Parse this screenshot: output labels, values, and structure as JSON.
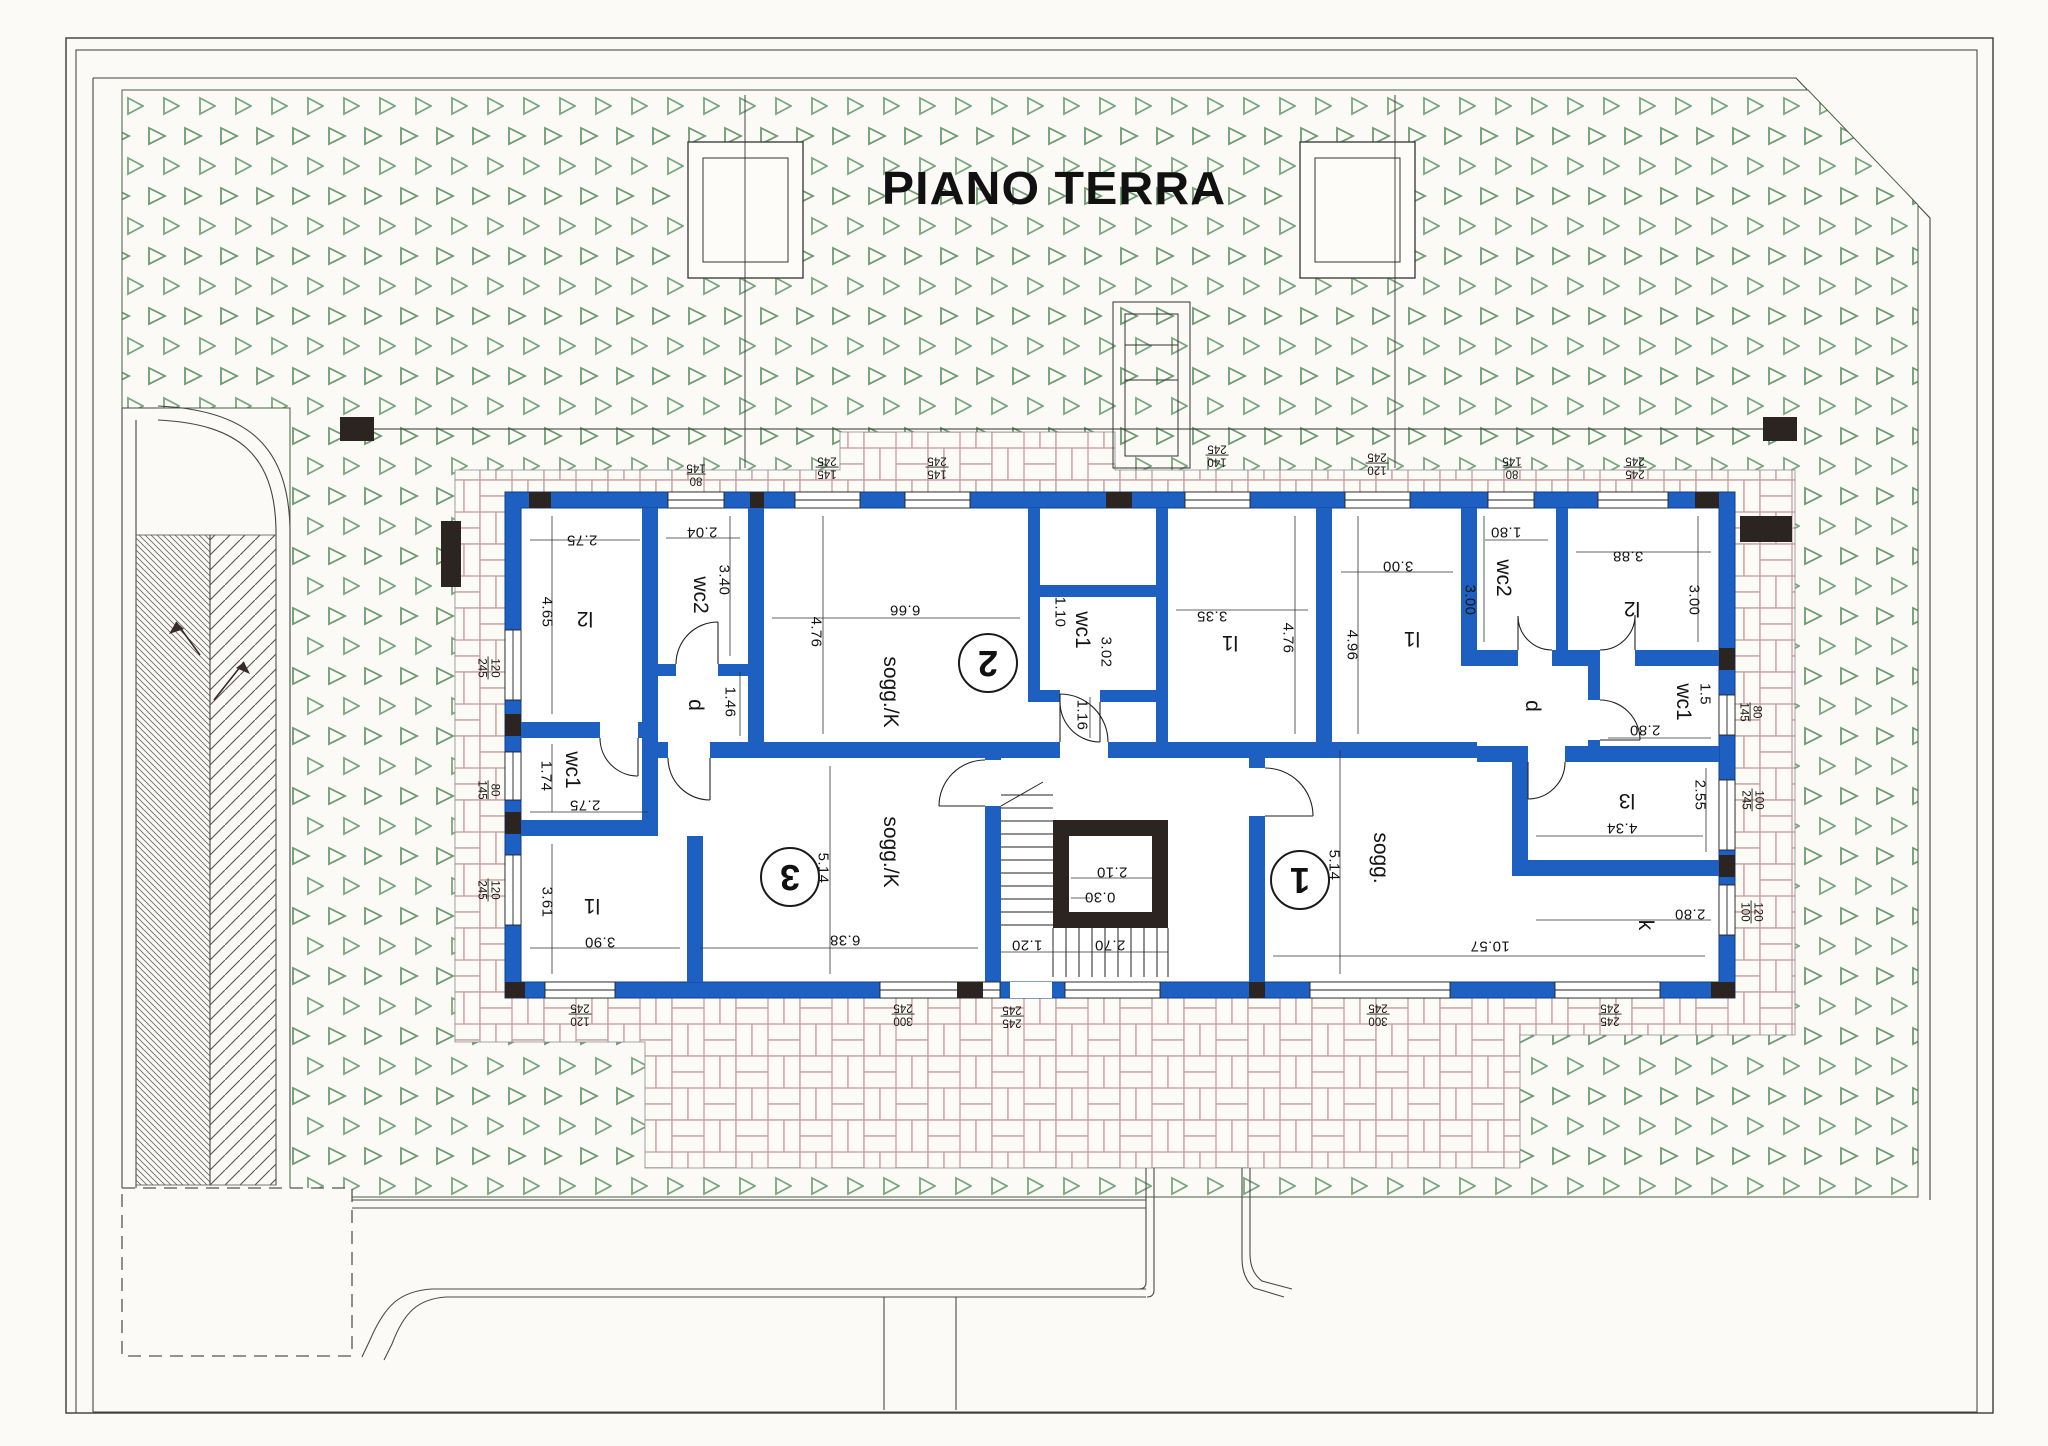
{
  "title": "PIANO TERRA",
  "apartments": {
    "apt1": {
      "number": "1"
    },
    "apt2": {
      "number": "2"
    },
    "apt3": {
      "number": "3"
    }
  },
  "rooms": {
    "a3_l2": {
      "label": "l2",
      "w": "2.75",
      "h": "4.65"
    },
    "a3_wc2": {
      "label": "wc2",
      "w": "2.04",
      "h": "3.40"
    },
    "a3_wc1": {
      "label": "wc1",
      "w": "2.75",
      "h": "1.74"
    },
    "a3_l1": {
      "label": "l1",
      "w": "3.90",
      "h": "3.61"
    },
    "a3_d": {
      "label": "d",
      "h": "1.46"
    },
    "a3_sogg": {
      "label": "sogg./K",
      "w": "6.38",
      "h": "5.14"
    },
    "a2_sogg": {
      "label": "sogg./K",
      "w": "6.66",
      "h": "4.76"
    },
    "a2_wc1": {
      "label": "wc1",
      "w": "3.02",
      "h": "1.10"
    },
    "a2_l1": {
      "label": "l1",
      "w": "3.35",
      "h": "4.76"
    },
    "a2_door": {
      "dim": "1.16"
    },
    "a1_l1": {
      "label": "l1",
      "w": "3.00",
      "h": "4.96"
    },
    "a1_wc2": {
      "label": "wc2",
      "w": "1.80",
      "h": "3.00"
    },
    "a1_l2": {
      "label": "l2",
      "w": "3.88",
      "h": "3.00"
    },
    "a1_wc1": {
      "label": "wc1",
      "w": "2.80",
      "h": "1.5"
    },
    "a1_d": {
      "label": "d"
    },
    "a1_l3": {
      "label": "l3",
      "w": "4.34",
      "h": "2.55"
    },
    "a1_k": {
      "label": "k",
      "w": "2.80"
    },
    "a1_sogg": {
      "label": "sogg.",
      "w": "10.57",
      "h": "5.14"
    }
  },
  "stair": {
    "shaft_w": "2.10",
    "step": "0.30",
    "flight1": "1.20",
    "flight2": "2.70"
  },
  "windows": {
    "t1": {
      "a": "80",
      "b": "145"
    },
    "t2": {
      "a": "145",
      "b": "245"
    },
    "t3": {
      "a": "145",
      "b": "245"
    },
    "t4": {
      "a": "140",
      "b": "245"
    },
    "t5": {
      "a": "120",
      "b": "245"
    },
    "t6": {
      "a": "80",
      "b": "145"
    },
    "t7": {
      "a": "245",
      "b": "245"
    },
    "l1": {
      "a": "120",
      "b": "245"
    },
    "l2": {
      "a": "80",
      "b": "145"
    },
    "l3": {
      "a": "120",
      "b": "245"
    },
    "r1": {
      "a": "80",
      "b": "145"
    },
    "r2": {
      "a": "100",
      "b": "245"
    },
    "r3": {
      "a": "120",
      "b": "100"
    },
    "b1": {
      "a": "120",
      "b": "245"
    },
    "b2": {
      "a": "300",
      "b": "245"
    },
    "b3": {
      "a": "245",
      "b": "245"
    },
    "b4": {
      "a": "300",
      "b": "245"
    },
    "b5": {
      "a": "245",
      "b": "245"
    }
  },
  "colors": {
    "wall_blue": "#1e5fc2",
    "core_black": "#2b2420",
    "garden_green": "#6b9c6e",
    "paving_line": "#c79c9c"
  }
}
